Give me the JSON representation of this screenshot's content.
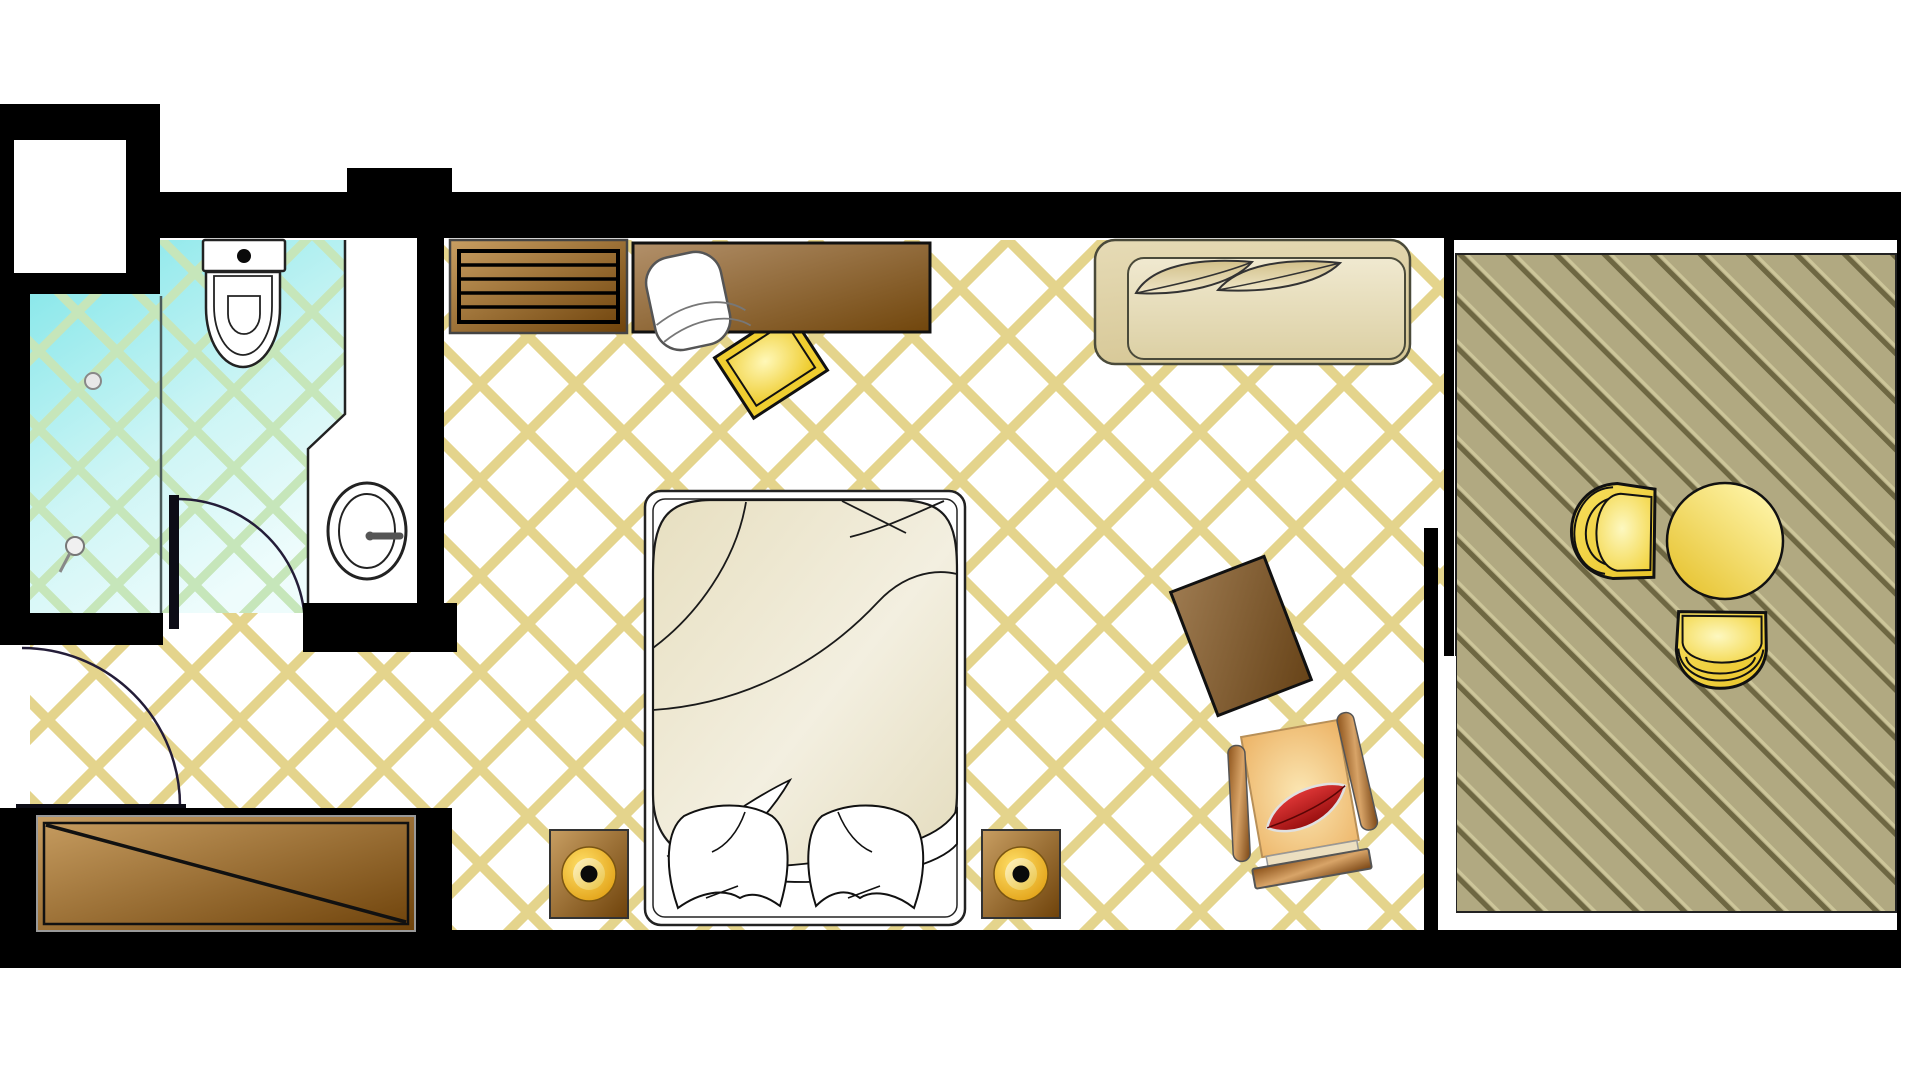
{
  "document": {
    "type": "hotel-room-floor-plan",
    "rooms": [
      "bathroom",
      "entry",
      "bedroom",
      "balcony"
    ],
    "furniture": [
      "toilet",
      "sink",
      "shower",
      "bathroom-door",
      "entry-door",
      "console-table",
      "luggage-bench",
      "desk",
      "desk-chair",
      "gold-stool",
      "double-bed",
      "pillows",
      "nightstand-left",
      "nightstand-right",
      "table-lamps",
      "sofa",
      "side-board",
      "armchair-red-cushion",
      "balcony-chair-left",
      "balcony-chair-bottom",
      "balcony-table"
    ]
  },
  "colors": {
    "wall": "#000000",
    "room_floor": "#ffffff",
    "room_line": "#e4d48c",
    "bath_tile": "#7de5e8",
    "bath_tile_pale": "#eefcfc",
    "bath_line": "#c6e6ba",
    "deck_base": "#b1a981",
    "deck_groove": "#6e6742",
    "deck_light": "#cdc69a",
    "wood_light": "#c89e62",
    "wood_dark": "#6e420a",
    "desk_light": "#b2906a",
    "desk_dark": "#71460c",
    "board_light": "#9d7a50",
    "board_dark": "#674318",
    "duvet": "#e7dfc0",
    "sofa_beige": "#e6dbb6",
    "sofa_inner": "#f0e9d0",
    "leaf_beige": "#d2c08a",
    "gold": "#f2d242",
    "gold_bright": "#fff8b8",
    "lamp_gold": "#ffe06a",
    "lamp_deep": "#dd9708",
    "table_gold": "#e7c433",
    "seat_tan": "#ecb264",
    "seat_glow": "#fdf8c0",
    "arm_wood": "#d8a468",
    "cushion_red": "#ef4040",
    "cushion_red_dark": "#860404",
    "outline": "#111111",
    "door_stroke": "#241d38"
  }
}
